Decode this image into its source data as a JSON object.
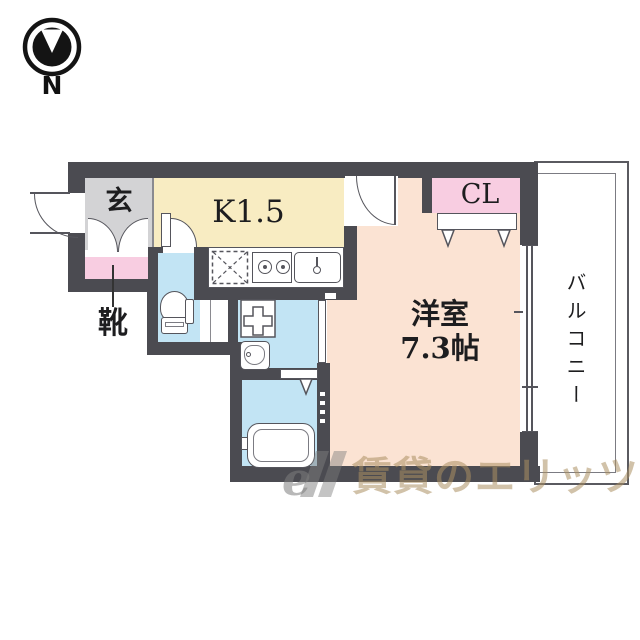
{
  "compass": {
    "label": "N"
  },
  "rooms": {
    "genkan": {
      "label": "玄",
      "color": "#d3d3d5"
    },
    "kitchen": {
      "label": "K1.5",
      "color": "#f8ecc2"
    },
    "closet": {
      "label": "CL",
      "color": "#f8cde1"
    },
    "western_room": {
      "label": "洋室",
      "size": "7.3帖",
      "color": "#fbe3d3"
    },
    "balcony": {
      "label": "バルコニー",
      "color": "#ffffff"
    },
    "shoe_cabinet": {
      "label": "靴",
      "color": "#f8cde1"
    },
    "toilet": {
      "color": "#c2e4f4"
    },
    "washroom": {
      "color": "#c2e4f4"
    },
    "bathroom": {
      "color": "#c2e4f4"
    }
  },
  "watermark": {
    "logo": "e",
    "text": "賃貸のエリッツ"
  },
  "colors": {
    "wall": "#4b4b51",
    "line": "#55555c",
    "background": "#ffffff"
  },
  "icons": [
    "north-compass-icon",
    "entrance-door-arc-icon",
    "shoe-cabinet-doors-icon",
    "toilet-icon",
    "washing-machine-icon",
    "washbasin-icon",
    "bathtub-icon",
    "stove-icon",
    "kitchen-sink-icon",
    "refrigerator-space-icon",
    "closet-folding-door-icon",
    "bath-folding-door-icon",
    "sliding-window-icon",
    "sliding-door-icon"
  ]
}
